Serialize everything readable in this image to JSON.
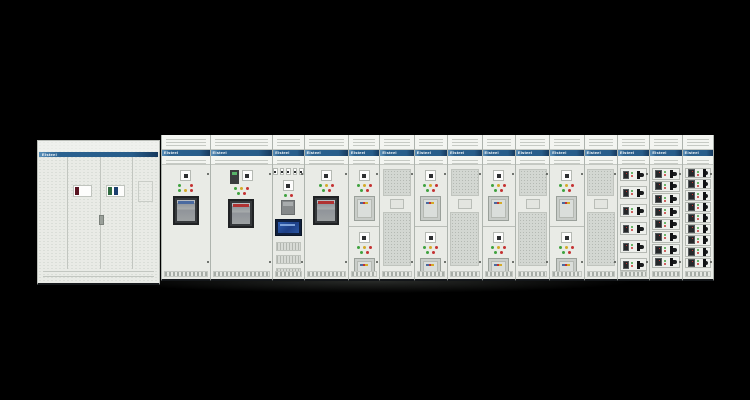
{
  "scene": {
    "description": "Photograph of an assembled low-voltage switchgear / motor control center lineup on a black background",
    "background_color": "#000000",
    "floor_shadow": true
  },
  "brand": "Elsteel",
  "colors": {
    "body": "#e9ebe6",
    "band_blue": "#2a618f",
    "band_blue_dark": "#173a5e",
    "mesh_grey": "#d3d7d2",
    "breaker_frame": "#35383b",
    "led_green": "#3fa23f",
    "led_red": "#c43232",
    "led_yellow": "#d4aa28",
    "led_off": "#e8e8e8",
    "hmi_blue": "#1d3f86",
    "handle_black": "#1a1c1e",
    "strip_darkred": "#5a1522",
    "strip_green": "#2f6b40",
    "strip_navy": "#1c3f6e",
    "acb_band_blue": "#4a6aa0",
    "acb_band_red": "#b03232"
  },
  "left_cabinet": {
    "band_label": "Elsteel",
    "doors": 2,
    "label_windows": [
      {
        "strips": [
          "#5a1522"
        ]
      },
      {
        "strips": [
          "#2f6b40",
          "#1c3f6e"
        ]
      }
    ]
  },
  "switchboard": {
    "sections": [
      {
        "id": "acb-incomer-1",
        "type": "acb",
        "width": 48,
        "meter": false,
        "breaker_band": "#4a6aa0",
        "leds": [
          [
            "green",
            "off",
            "red"
          ],
          [
            "green",
            "yellow",
            "red"
          ]
        ]
      },
      {
        "id": "acb-incomer-2",
        "type": "acb",
        "width": 62,
        "meter": true,
        "breaker_band": "#b03232",
        "leds": [
          [
            "green",
            "yellow",
            "red"
          ],
          [
            "green",
            "red"
          ]
        ]
      },
      {
        "id": "control-hmi",
        "type": "control",
        "width": 31,
        "indicator_chips": 5,
        "terminal_rows": 4
      },
      {
        "id": "acb-buscoupler",
        "type": "acb",
        "width": 44,
        "meter": false,
        "breaker_band": "#b03232",
        "leds": [
          [
            "green",
            "yellow",
            "red"
          ],
          [
            "green",
            "red"
          ]
        ]
      },
      {
        "id": "feeder-1",
        "type": "feeder",
        "width": 31,
        "modules": 2,
        "leds": [
          [
            "green",
            "yellow",
            "red"
          ],
          [
            "green",
            "red"
          ]
        ]
      },
      {
        "id": "mesh-door-1",
        "type": "mesh",
        "width": 34
      },
      {
        "id": "feeder-2",
        "type": "feeder",
        "width": 33,
        "modules": 2,
        "leds": [
          [
            "green",
            "yellow",
            "red"
          ],
          [
            "green",
            "red"
          ]
        ]
      },
      {
        "id": "mesh-door-2",
        "type": "mesh",
        "width": 34
      },
      {
        "id": "feeder-3",
        "type": "feeder",
        "width": 33,
        "modules": 2,
        "leds": [
          [
            "green",
            "yellow",
            "red"
          ],
          [
            "green",
            "red"
          ]
        ]
      },
      {
        "id": "mesh-door-3",
        "type": "mesh",
        "width": 34
      },
      {
        "id": "feeder-4",
        "type": "feeder",
        "width": 34,
        "modules": 2,
        "leds": [
          [
            "green",
            "yellow",
            "red"
          ],
          [
            "green",
            "red"
          ]
        ]
      },
      {
        "id": "mesh-door-4",
        "type": "mesh",
        "width": 33
      },
      {
        "id": "mcc-drawers-1",
        "type": "drawers",
        "width": 32,
        "rows": 6,
        "gapped": true,
        "wide_display": false
      },
      {
        "id": "mcc-drawers-2",
        "type": "drawers",
        "width": 32,
        "rows": 8,
        "gapped": false,
        "wide_display": false
      },
      {
        "id": "mcc-drawers-3",
        "type": "drawers",
        "width": 32,
        "rows": 9,
        "gapped": false,
        "wide_display": true
      }
    ]
  }
}
